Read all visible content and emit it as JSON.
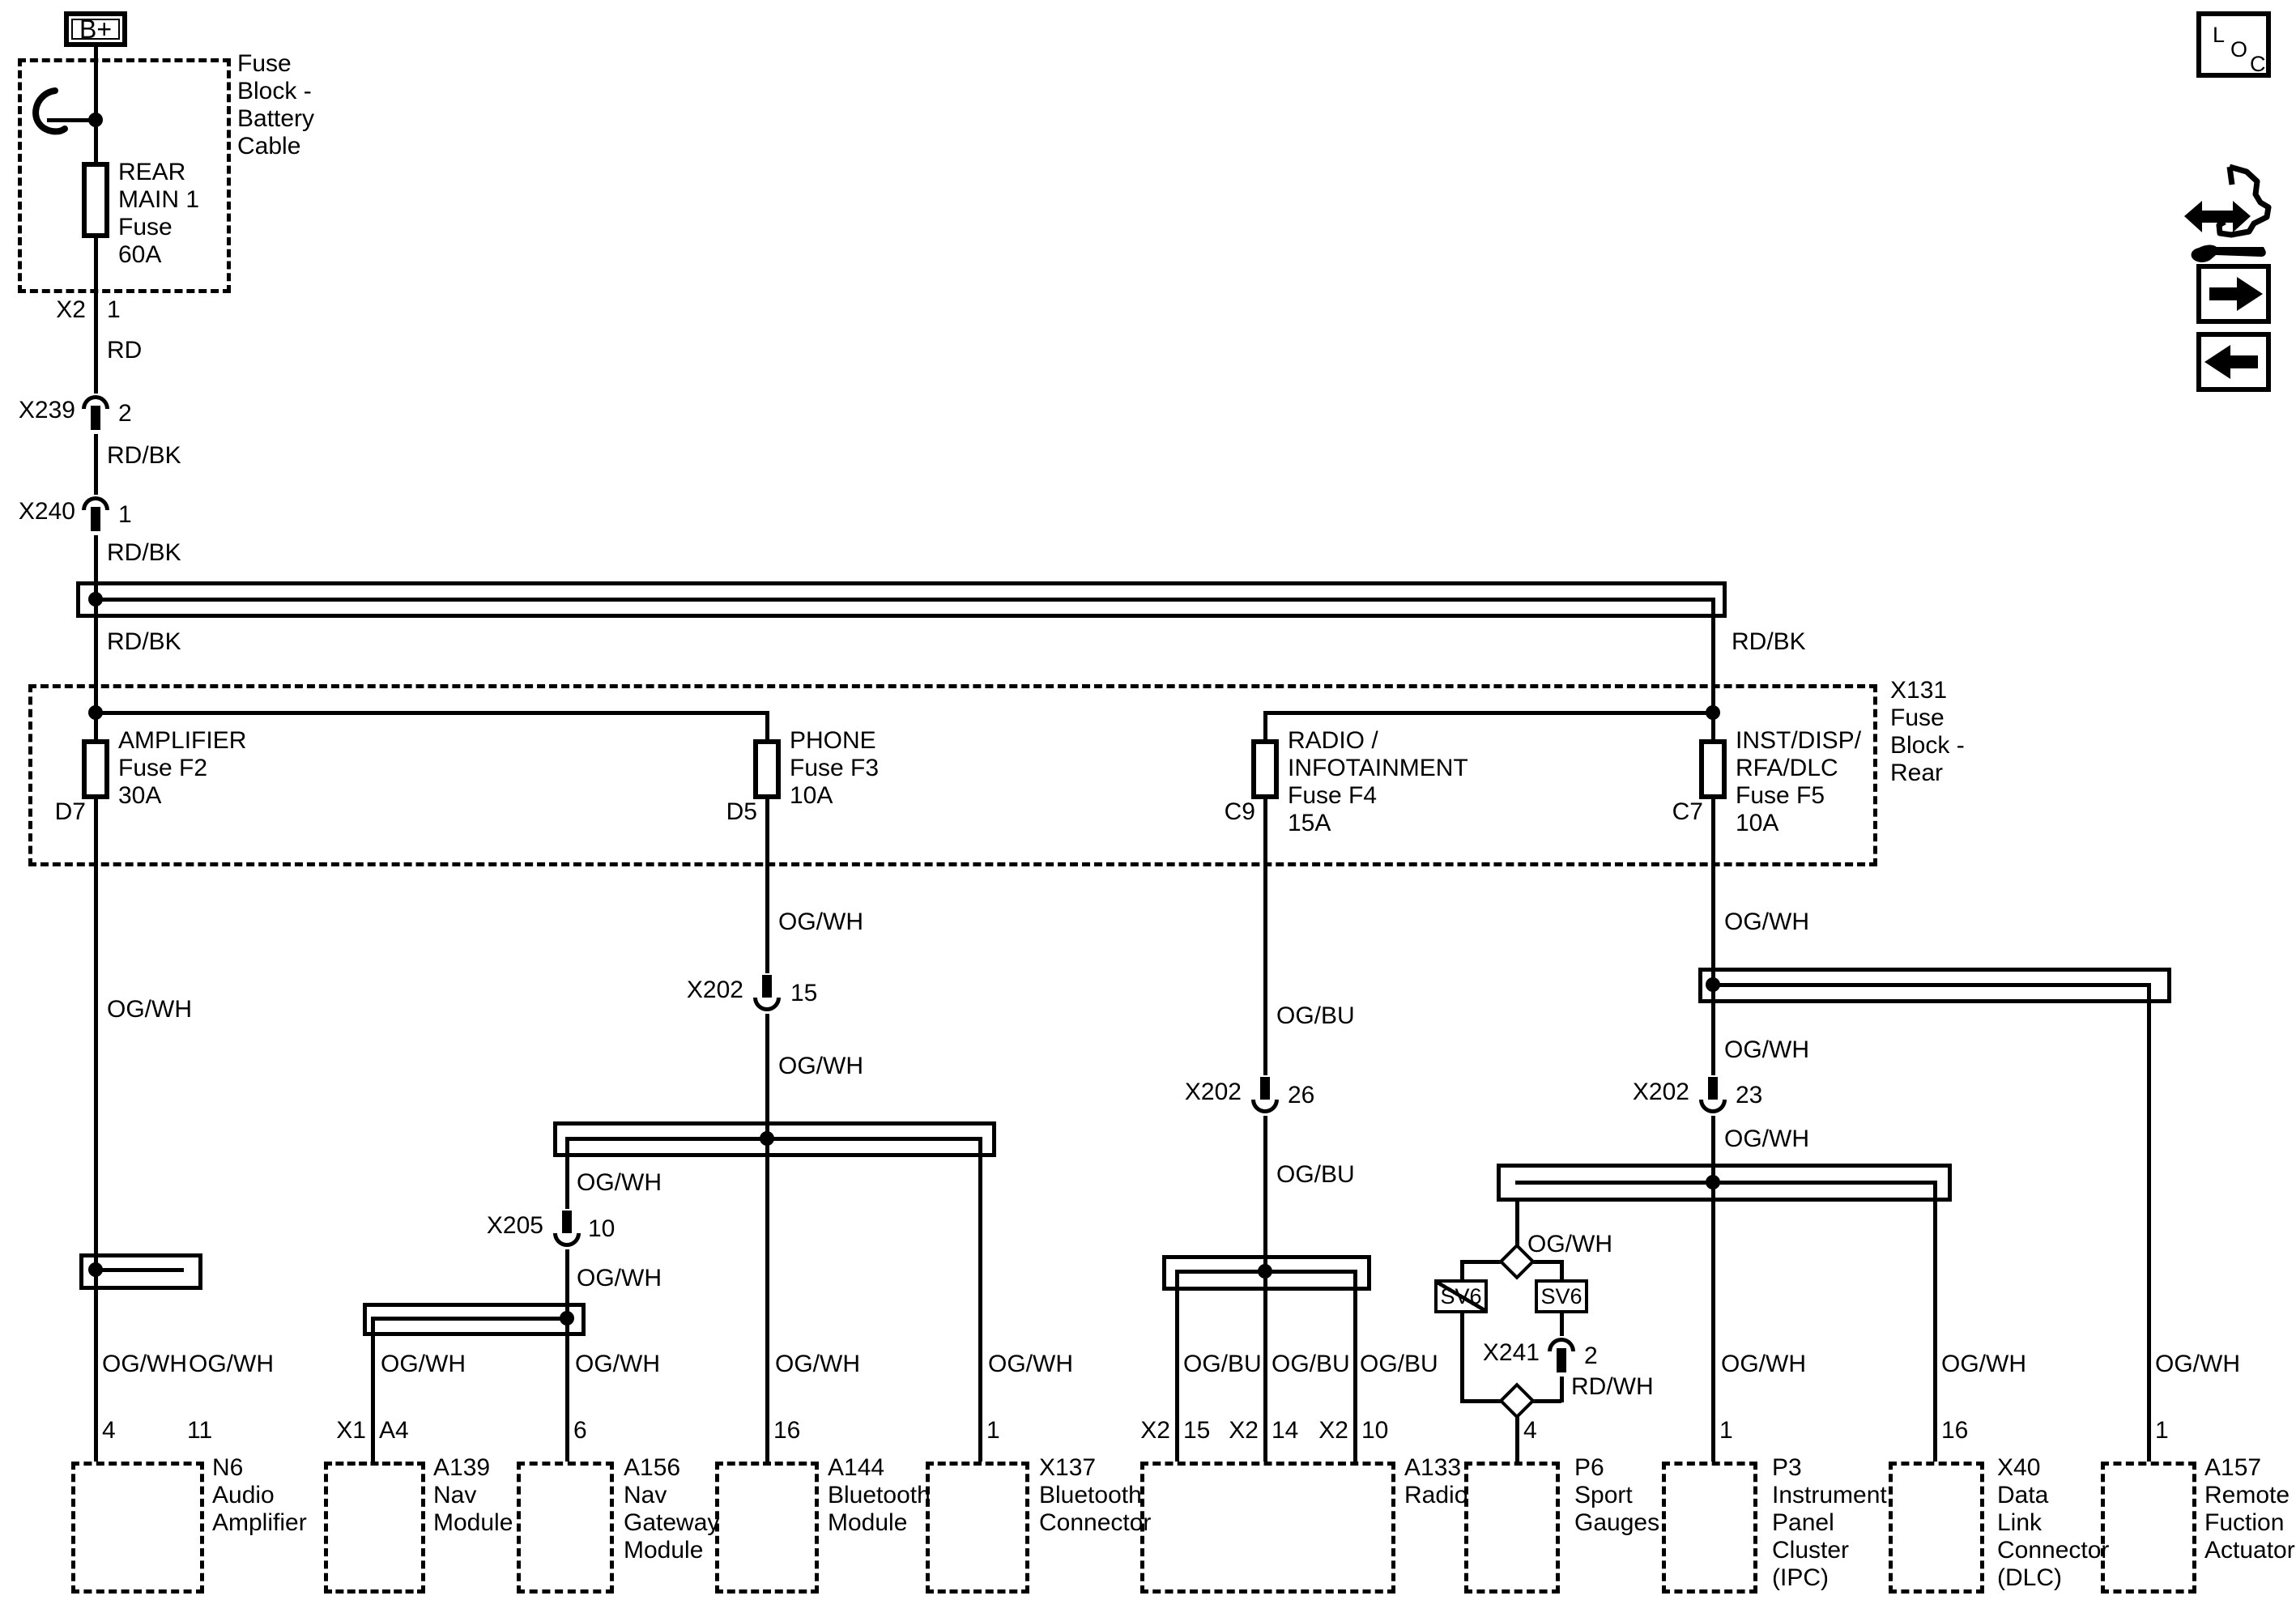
{
  "colors": {
    "line": "#000000",
    "background": "#ffffff"
  },
  "diagram": {
    "power_feed": {
      "b_plus": "B+",
      "battery_cable_box_label": "Fuse\nBlock -\nBattery\nCable",
      "rear_main_fuse_label": "REAR\nMAIN 1\nFuse\n60A",
      "x2": {
        "name": "X2",
        "pin": "1"
      },
      "wire_rd": "RD",
      "x239": {
        "name": "X239",
        "pin": "2"
      },
      "wire_rdbk_1": "RD/BK",
      "x240": {
        "name": "X240",
        "pin": "1"
      },
      "wire_rdbk_2": "RD/BK",
      "wire_rdbk_3": "RD/BK",
      "wire_rdbk_4": "RD/BK"
    },
    "fuse_block_rear": {
      "label": "X131\nFuse\nBlock -\nRear",
      "fuses": [
        {
          "label": "AMPLIFIER\nFuse F2\n30A",
          "pin": "D7"
        },
        {
          "label": "PHONE\nFuse F3\n10A",
          "pin": "D5"
        },
        {
          "label": "RADIO /\nINFOTAINMENT\nFuse F4\n15A",
          "pin": "C9"
        },
        {
          "label": "INST/DISP/\nRFA/DLC\nFuse F5\n10A",
          "pin": "C7"
        }
      ]
    },
    "connectors": {
      "x202_15": {
        "name": "X202",
        "pin": "15"
      },
      "x205_10": {
        "name": "X205",
        "pin": "10"
      },
      "x202_26": {
        "name": "X202",
        "pin": "26"
      },
      "x202_23": {
        "name": "X202",
        "pin": "23"
      },
      "x241_2": {
        "name": "X241",
        "pin": "2"
      }
    },
    "wire_labels": {
      "ogwh_amp": "OG/WH",
      "ogwh_phone_upper": "OG/WH",
      "ogwh_phone_lower": "OG/WH",
      "ogwh_x205_upper": "OG/WH",
      "ogwh_x205_lower": "OG/WH",
      "ogbu_upper": "OG/BU",
      "ogbu_lower": "OG/BU",
      "ogwh_inst_upper": "OG/WH",
      "ogwh_inst_mid": "OG/WH",
      "ogwh_inst_lower": "OG/WH",
      "ogwh_p6_branch": "OG/WH",
      "rdwh": "RD/WH",
      "ogwh_n6_4": "OG/WH",
      "ogwh_n6_11": "OG/WH",
      "ogwh_a139": "OG/WH",
      "ogwh_a156": "OG/WH",
      "ogwh_a144": "OG/WH",
      "ogwh_x137": "OG/WH",
      "ogbu_radio_15": "OG/BU",
      "ogbu_radio_14": "OG/BU",
      "ogbu_radio_10": "OG/BU",
      "ogwh_p3": "OG/WH",
      "ogwh_x40": "OG/WH",
      "ogwh_a157": "OG/WH"
    },
    "sv6_left": "SV6",
    "sv6_right": "SV6",
    "components": [
      {
        "id": "n6",
        "label": "N6\nAudio\nAmplifier",
        "pin_a": "4",
        "pin_b": "11"
      },
      {
        "id": "a139",
        "label": "A139\nNav\nModule",
        "conn": "X1",
        "pin_a": "A4"
      },
      {
        "id": "a156",
        "label": "A156\nNav\nGateway\nModule",
        "pin_a": "6"
      },
      {
        "id": "a144",
        "label": "A144\nBluetooth\nModule",
        "pin_a": "16"
      },
      {
        "id": "x137",
        "label": "X137\nBluetooth\nConnector",
        "pin_a": "1"
      },
      {
        "id": "a133",
        "label": "A133\nRadio",
        "pins": [
          {
            "conn": "X2",
            "pin": "15"
          },
          {
            "conn": "X2",
            "pin": "14"
          },
          {
            "conn": "X2",
            "pin": "10"
          }
        ]
      },
      {
        "id": "p6",
        "label": "P6\nSport\nGauges",
        "pin_a": "4"
      },
      {
        "id": "p3",
        "label": "P3\nInstrument\nPanel\nCluster\n(IPC)",
        "pin_a": "1"
      },
      {
        "id": "x40",
        "label": "X40\nData\nLink\nConnector\n(DLC)",
        "pin_a": "16"
      },
      {
        "id": "a157",
        "label": "A157\nRemote\nFuction\nActuator",
        "pin_a": "1"
      }
    ],
    "toolbar": {
      "loc_l": "L",
      "loc_o": "O",
      "loc_c": "C"
    }
  }
}
